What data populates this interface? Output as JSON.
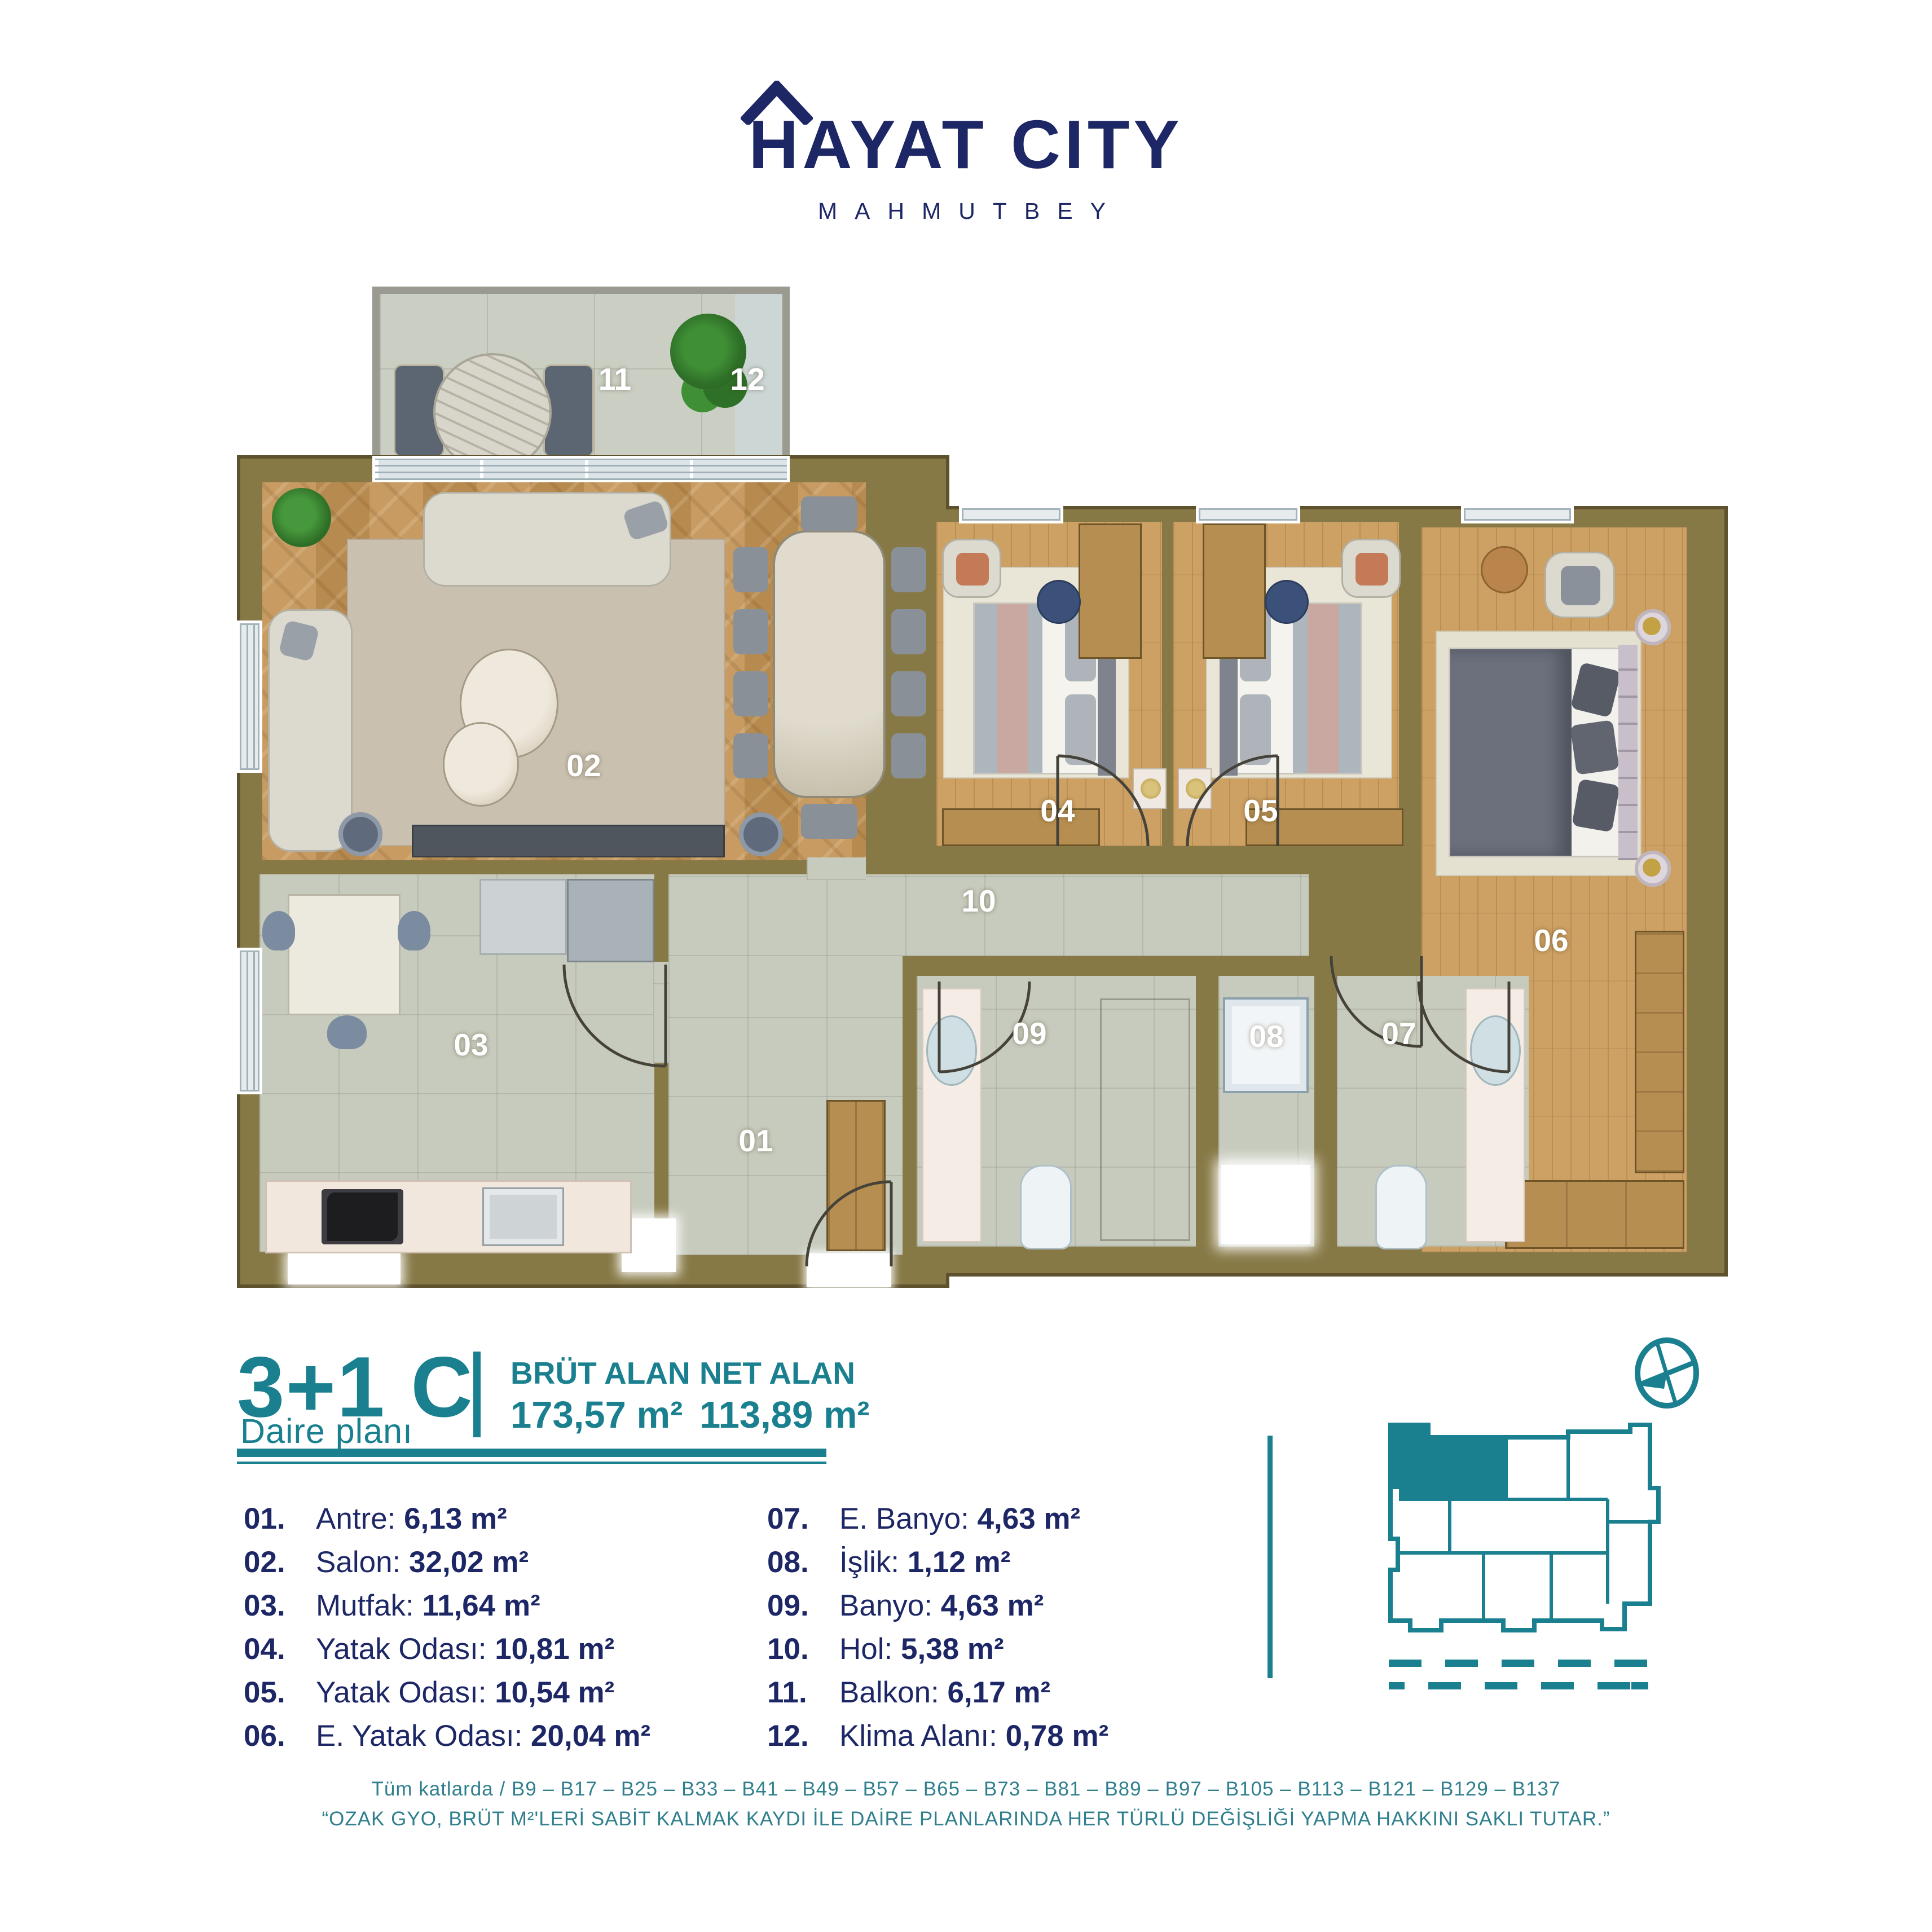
{
  "logo": {
    "title": "HAYAT CITY",
    "subtitle": "MAHMUTBEY"
  },
  "plan": {
    "labels": {
      "l01": "01",
      "l02": "02",
      "l03": "03",
      "l04": "04",
      "l05": "05",
      "l06": "06",
      "l07": "07",
      "l08": "08",
      "l09": "09",
      "l10": "10",
      "l11": "11",
      "l12": "12"
    }
  },
  "legend": {
    "type": "3+1 C",
    "subtitle": "Daire planı",
    "brut_label": "BRÜT ALAN",
    "brut_value": "173,57 m²",
    "net_label": "NET ALAN",
    "net_value": "113,89 m²"
  },
  "rooms": [
    {
      "num": "01.",
      "name": "Antre:",
      "area": "6,13 m²"
    },
    {
      "num": "02.",
      "name": "Salon:",
      "area": "32,02 m²"
    },
    {
      "num": "03.",
      "name": "Mutfak:",
      "area": "11,64 m²"
    },
    {
      "num": "04.",
      "name": "Yatak Odası:",
      "area": "10,81 m²"
    },
    {
      "num": "05.",
      "name": "Yatak Odası:",
      "area": "10,54 m²"
    },
    {
      "num": "06.",
      "name": "E. Yatak Odası:",
      "area": "20,04 m²"
    },
    {
      "num": "07.",
      "name": "E. Banyo:",
      "area": "4,63 m²"
    },
    {
      "num": "08.",
      "name": "İşlik:",
      "area": "1,12 m²"
    },
    {
      "num": "09.",
      "name": "Banyo:",
      "area": "4,63 m²"
    },
    {
      "num": "10.",
      "name": "Hol:",
      "area": "5,38 m²"
    },
    {
      "num": "11.",
      "name": "Balkon:",
      "area": "6,17 m²"
    },
    {
      "num": "12.",
      "name": "Klima Alanı:",
      "area": "0,78 m²"
    }
  ],
  "footer": {
    "line1": "Tüm katlarda / B9 – B17 – B25 – B33 – B41 – B49 – B57 – B65 – B73 – B81 – B89 – B97 – B105 – B113 – B121 – B129 – B137",
    "line2": "“OZAK GYO, BRÜT M²'LERİ SABİT KALMAK KAYDI İLE DAİRE PLANLARINDA HER TÜRLÜ DEĞİŞLİĞİ YAPMA HAKKINI SAKLI TUTAR.”"
  },
  "colors": {
    "navy": "#1d2766",
    "teal": "#1a808f",
    "wall": "#877946"
  }
}
